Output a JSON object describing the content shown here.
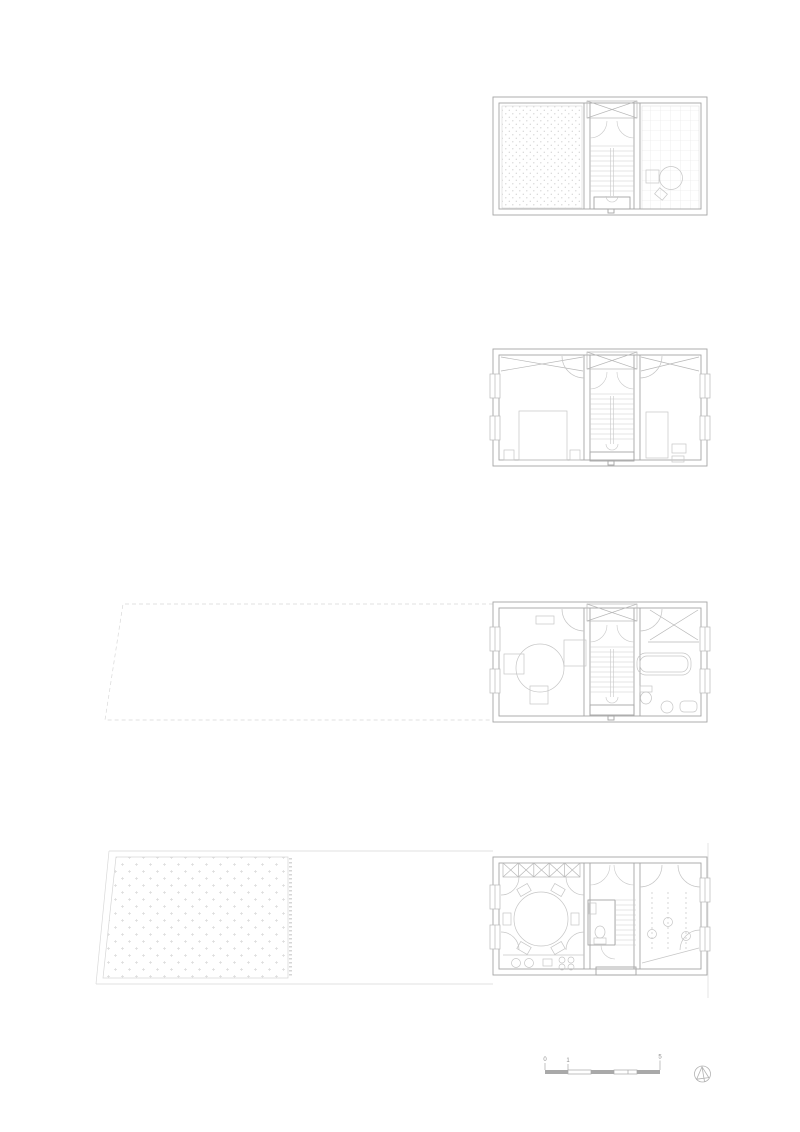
{
  "sheet": {
    "type": "architectural-floor-plan-set",
    "background": "#ffffff"
  },
  "colors": {
    "wall": "#a6a6a6",
    "partition": "#b8b8b8",
    "stair": "#c9c9c9",
    "furniture": "#c6c6c6",
    "pattern": "#d6d6d6",
    "site": "#d9d9d9",
    "scale_bar": "#a9a9a9",
    "label": "#8f8f8f",
    "north": "#b3b3b3"
  },
  "scale_bar": {
    "labels": [
      "0",
      "1",
      "5"
    ]
  }
}
